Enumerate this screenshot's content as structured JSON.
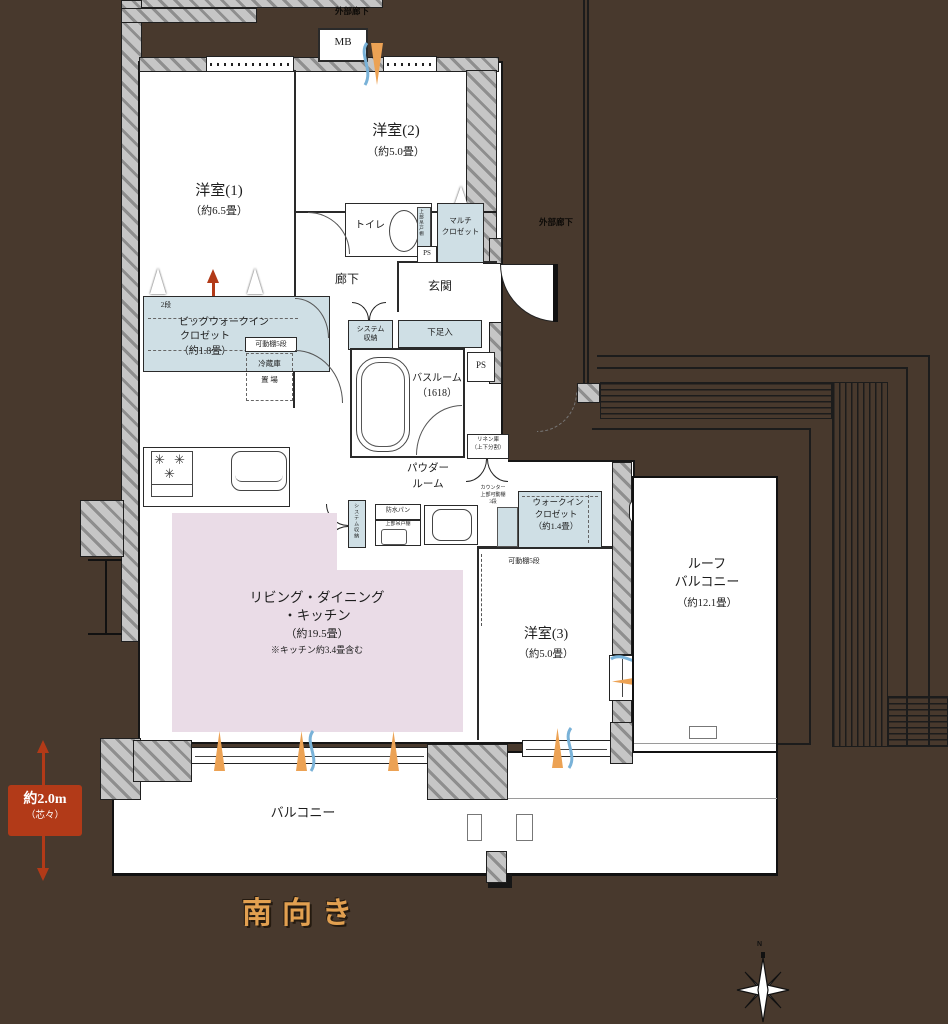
{
  "colors": {
    "background": "#48392d",
    "wall_gray": "#c6c6c6",
    "closet_blue": "#cfdfe5",
    "ldk_pink": "#eadce7",
    "accent_red": "#b23a18",
    "south_orange": "#e2a050",
    "flame_orange": "#eca254",
    "breeze_blue": "#79b2d8"
  },
  "labels": {
    "exterior_corridor_top": "外部廊下",
    "exterior_corridor_right": "外部廊下",
    "mb": "MB",
    "room1_name": "洋室(1)",
    "room1_size": "（約6.5畳）",
    "room2_name": "洋室(2)",
    "room2_size": "（約5.0畳）",
    "toilet": "トイレ",
    "toilet_upper_shelf": "上部吊戸棚",
    "ps_top": "PS",
    "ps_mid": "PS",
    "multi_closet_1": "マルチ",
    "multi_closet_2": "クロゼット",
    "hallway": "廊下",
    "entrance": "玄関",
    "two_way": "2WAY",
    "big_wic_tier": "2段",
    "big_wic_1": "ビッグウォークイン",
    "big_wic_2": "クロゼット",
    "big_wic_size": "（約1.8畳）",
    "movable_shelf_1": "可動棚5段",
    "movable_shelf_2": "可動棚5段",
    "fridge_1": "冷蔵庫",
    "fridge_2": "置 場",
    "system_storage_1": "システム",
    "system_storage_2": "収納",
    "system_storage_v": "システム収納",
    "shoe_box": "下足入",
    "bath_1": "バスルーム",
    "bath_2": "（1618）",
    "linen_1": "リネン庫",
    "linen_2": "（上下分割）",
    "powder_1": "パウダー",
    "powder_2": "ルーム",
    "counter_1": "カウンター",
    "counter_2": "上部可動棚",
    "counter_3": "3段",
    "waterproof": "防水パン",
    "upper_cabinet": "上部吊戸棚",
    "wic_1": "ウォークイン",
    "wic_2": "クロゼット",
    "wic_size": "（約1.4畳）",
    "sk": "SK",
    "ldk_1": "リビング・ダイニング",
    "ldk_2": "・キッチン",
    "ldk_size": "（約19.5畳）",
    "ldk_note": "※キッチン約3.4畳含む",
    "room3_name": "洋室(3)",
    "room3_size": "（約5.0畳）",
    "roof_1": "ルーフ",
    "roof_2": "バルコニー",
    "roof_size": "（約12.1畳）",
    "balcony": "バルコニー",
    "south": "南向き",
    "depth_1": "約2.0m",
    "depth_2": "（芯々）",
    "compass_n": "N"
  }
}
